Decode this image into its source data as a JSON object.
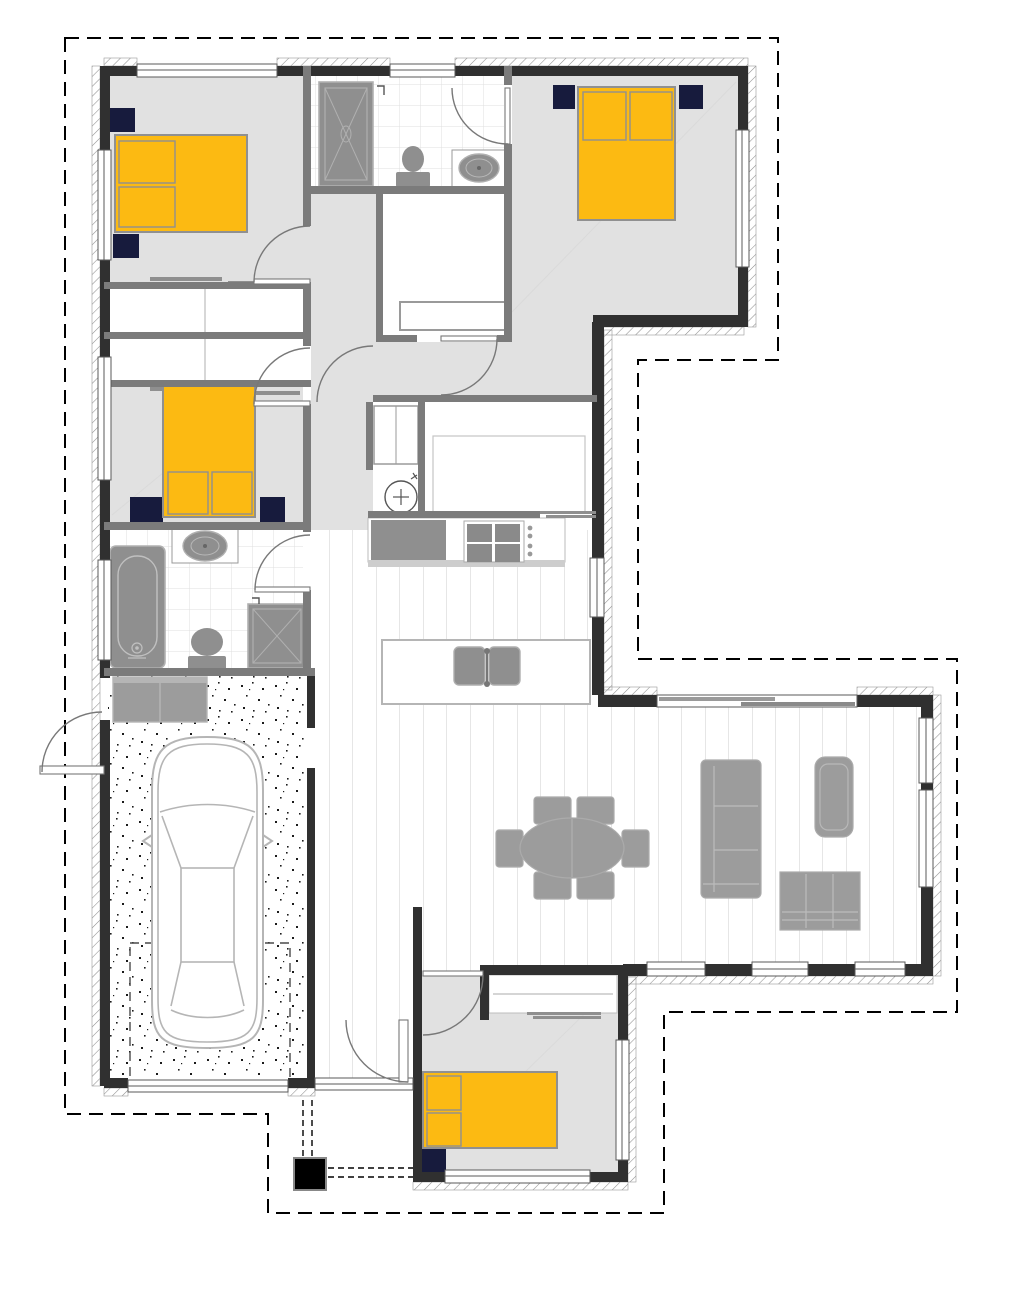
{
  "title": "single-storey house floor plan",
  "colors": {
    "wall_ext": "#303030",
    "wall_int": "#7b7b7b",
    "floor_room": "#e1e1e1",
    "bed": "#fcba12",
    "bed_stroke": "#909090",
    "nightstand": "#171b3d",
    "furniture": "#9c9c9c",
    "fixture": "#8f8f8f",
    "plank_line": "#cccccc",
    "tile_line": "#dfdfdf",
    "hatch_line": "#8f8f8f",
    "window_frame": "#5a5a5a",
    "door_arc": "#787878",
    "boundary": "#000000",
    "car_line": "#b5b5b5",
    "post": "#000000"
  },
  "plan": {
    "rooms": [
      {
        "name": "bedroom-1",
        "furniture": [
          "double-bed",
          "nightstand",
          "nightstand",
          "wardrobe"
        ]
      },
      {
        "name": "bedroom-2",
        "furniture": [
          "double-bed",
          "nightstand",
          "nightstand",
          "walk-in-robe",
          "ensuite"
        ]
      },
      {
        "name": "bedroom-3",
        "furniture": [
          "double-bed",
          "nightstand",
          "nightstand",
          "wardrobe"
        ]
      },
      {
        "name": "bedroom-4",
        "furniture": [
          "double-bed",
          "nightstand",
          "wardrobe"
        ]
      },
      {
        "name": "ensuite",
        "furniture": [
          "shower",
          "toilet",
          "vanity"
        ]
      },
      {
        "name": "bathroom",
        "furniture": [
          "bathtub",
          "vanity",
          "toilet",
          "shower"
        ]
      },
      {
        "name": "kitchen",
        "furniture": [
          "fridge",
          "pantry",
          "cooktop",
          "island-sink",
          "hot-water-cylinder"
        ]
      },
      {
        "name": "dining",
        "furniture": [
          "oval-table",
          "six-chairs"
        ]
      },
      {
        "name": "living",
        "furniture": [
          "sofa",
          "armchair",
          "sideboard"
        ]
      },
      {
        "name": "garage",
        "furniture": [
          "car",
          "laundry-bench",
          "parking-bay"
        ]
      },
      {
        "name": "entry-walkway",
        "furniture": [
          "front-door",
          "porch-post"
        ]
      }
    ],
    "bed_count": 4,
    "boundary_style": "dashed eave outline"
  }
}
